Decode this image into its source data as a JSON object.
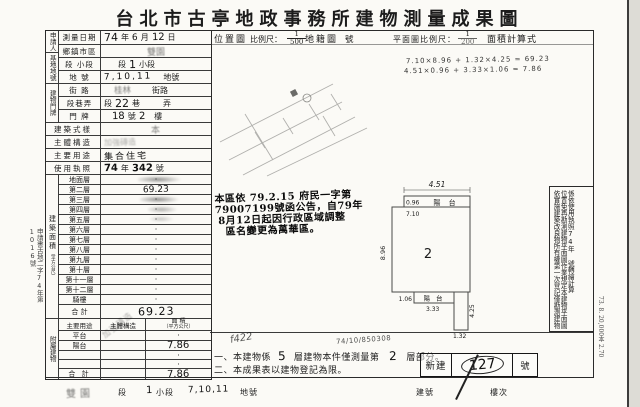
{
  "page": {
    "title": "台北市古亭地政事務所建物測量成果圖"
  },
  "header": {
    "applicant_label": "申請人",
    "survey_date_label": "測量日期",
    "date_year": "74",
    "date_year_suffix": "年",
    "date_month": "6",
    "date_month_suffix": "月",
    "date_day": "12",
    "date_day_suffix": "日",
    "location_map_label": "位置圖",
    "scale_label": "比例尺：",
    "scale_num": "1",
    "scale_den": "500",
    "cadastral_map_label": "地籍圖",
    "sheet_no_label": "號",
    "plan_scale_label": "平面圖比例尺：",
    "plan_scale_num": "1",
    "plan_scale_den": "200",
    "area_formula_label": "面積計算式"
  },
  "formula": {
    "line1": "7.10×8.96 + 1.32×4.25 = 69.23",
    "line2": "4.51×0.96 + 3.33×1.06 = 7.86"
  },
  "site": {
    "group_label": "基地地號",
    "district_label": "鄉鎮市區",
    "district_value": "雙園",
    "section_label": "段 小段",
    "section_value_pre": "段",
    "section_value_num": "1",
    "section_value_suf": "小段",
    "parcel_label": "地 號",
    "parcel_value": "7,10,11",
    "parcel_suffix": "地號"
  },
  "address": {
    "group_label": "建物門牌",
    "street_label": "街 路",
    "street_value": "桂林",
    "street_suffix": "街路",
    "lane_label": "段巷弄",
    "lane_pre": "段",
    "lane_value": "22",
    "lane_mid": "巷",
    "lane_suf": "弄",
    "door_label": "門 牌",
    "door_value": "18",
    "door_mid": "號",
    "door_floor": "2",
    "door_suf": "樓"
  },
  "building": {
    "style_label": "建築式樣",
    "style_value": "本",
    "structure_label": "主體構造",
    "structure_value": "加強磚造",
    "usage_label": "主要用途",
    "usage_value": "集合住宅",
    "license_label": "使用執照",
    "license_year": "74",
    "license_year_suffix": "年",
    "license_no": "342",
    "license_no_suffix": "號"
  },
  "area": {
    "group_label": "建築面積",
    "group_label_sub": "（平方公尺）",
    "floors": [
      {
        "label": "地面層",
        "value": "·"
      },
      {
        "label": "第二層",
        "value": "69.23"
      },
      {
        "label": "第三層",
        "value": "·"
      },
      {
        "label": "第四層",
        "value": "·"
      },
      {
        "label": "第五層",
        "value": "·"
      },
      {
        "label": "第六層",
        "value": "·"
      },
      {
        "label": "第七層",
        "value": "·"
      },
      {
        "label": "第八層",
        "value": "·"
      },
      {
        "label": "第九層",
        "value": "·"
      },
      {
        "label": "第十層",
        "value": "·"
      },
      {
        "label": "第十一層",
        "value": "·"
      },
      {
        "label": "第十二層",
        "value": "·"
      },
      {
        "label": "騎樓",
        "value": "·"
      }
    ],
    "total_label": "合 計",
    "total_value": "69.23"
  },
  "annex": {
    "group_label": "附屬建物",
    "usage_header": "主要用途",
    "structure_header": "主體構造",
    "area_header": "面 積",
    "area_header_sub": "（平方公尺）",
    "rows": [
      {
        "label": "平台",
        "value": "·"
      },
      {
        "label": "陽台",
        "value": "7.86"
      },
      {
        "label": "",
        "value": "·"
      },
      {
        "label": "",
        "value": "·"
      }
    ],
    "structure_note": "加強磚造",
    "total_label": "合 計",
    "total_value": "7.86"
  },
  "margin_stamp": {
    "part1": "申請書",
    "part2": "古地二字",
    "part3": "年第",
    "year": "74",
    "number": "1016",
    "suffix": "號"
  },
  "rename_stamp": {
    "lines": [
      "本區依 79.2.15 府民一字第",
      "79007199號函公告，自79年",
      "8月12日起因行政區域調整",
      "區名變更為萬華區。"
    ]
  },
  "plan": {
    "room_label": "2",
    "balcony_top_label": "陽 台",
    "balcony_bottom_label": "陽 台",
    "dim_top_width": "4.51",
    "dim_top_depth": "0.96",
    "dim_main_width": "7.10",
    "dim_main_height": "8.96",
    "dim_bottom_depth": "1.06",
    "dim_bottom_width": "3.33",
    "dim_ext_width": "1.32",
    "dim_ext_height": "4.25"
  },
  "sidebar": {
    "col1": "依實施建築改良物所有權第一次登記僅勘測建物",
    "col2": "位置免再勘測建物平面圖作業規定本建物平面圖",
    "col3a": "係依使用執照",
    "col3b": "74",
    "col3c": "年",
    "col3d": "號轉繪計算"
  },
  "notes": {
    "note1_pre": "一、本建物係",
    "note1_floors": "5",
    "note1_mid": "層建物本件僅測量第",
    "note1_floor": "2",
    "note1_suf": "層部分。",
    "note2": "二、本成果表以建物登記為限。",
    "scribble": "f422",
    "serial": "74/10/850308"
  },
  "stamp_box": {
    "left": "新建",
    "number": "127",
    "right": "號"
  },
  "print_info": "73. 8. 20,000本 2.70",
  "footer": {
    "area_value": "雙園",
    "seg_label": "段",
    "seg_value": "1",
    "subseg_label": "小段",
    "parcel_value": "7,10,11",
    "parcel_label": "地號",
    "bldg_no_label": "建號",
    "floor_label": "樓次"
  }
}
